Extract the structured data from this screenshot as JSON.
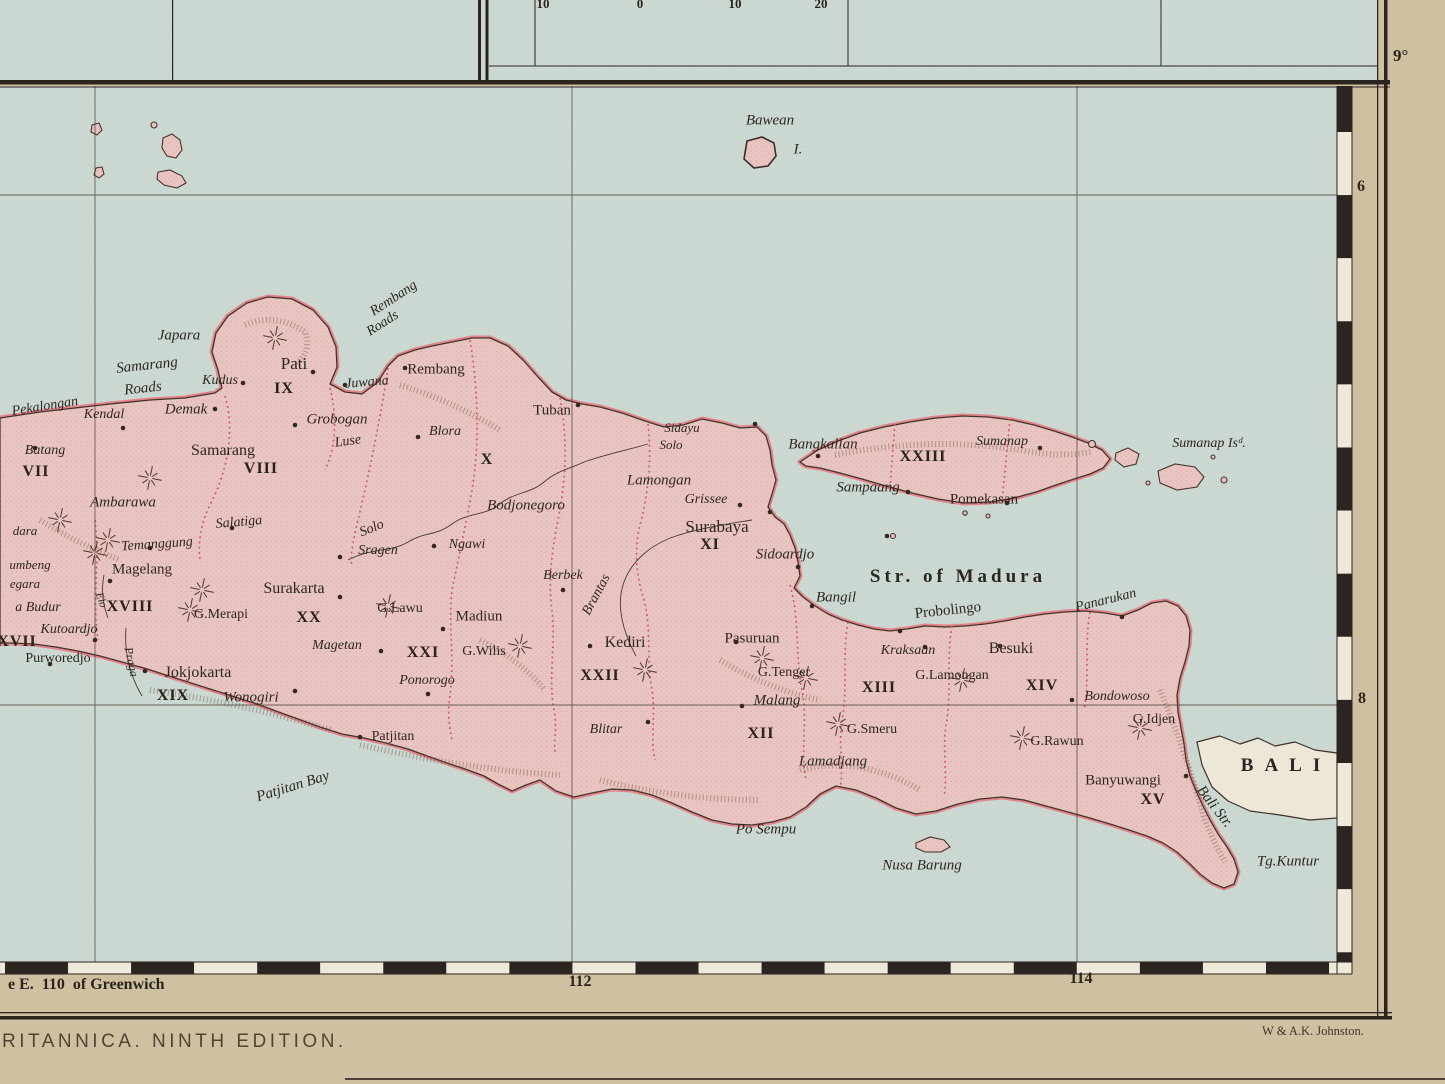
{
  "chrome": {
    "edition_text": "RITANNICA. NINTH EDITION.",
    "attribution": "W & A.K. Johnston.",
    "greenwich_label": "e E.  110  of Greenwich",
    "lon_112": "112",
    "lon_114": "114",
    "lat_9": "9°",
    "lat_6": "6",
    "lat_8": "8",
    "scale_numbers": [
      "10",
      "0",
      "10",
      "20"
    ]
  },
  "map": {
    "colors": {
      "sea": "#ccd8d2",
      "land": "#e9c5c1",
      "coast_band": "#e2858b",
      "outline": "#43342b",
      "boundary_red": "#cf5168",
      "paper_margin": "#cfc0a2",
      "ink": "#2b241e",
      "bali_fill": "#ede7d8"
    },
    "labels": [
      {
        "id": "bawean",
        "t": "Bawean",
        "x": 770,
        "y": 121,
        "c": "ital",
        "s": 15
      },
      {
        "id": "bawean-i",
        "t": "I.",
        "x": 798,
        "y": 150,
        "c": "ital",
        "s": 15
      },
      {
        "id": "str-of-madura",
        "t": "Str. of Madura",
        "x": 958,
        "y": 577,
        "c": "water",
        "s": 19,
        "ls": 4
      },
      {
        "id": "bali",
        "t": "BALI",
        "x": 1286,
        "y": 766,
        "c": "water",
        "s": 19,
        "ls": 11
      },
      {
        "id": "bali-str",
        "t": "Bali Str.",
        "x": 1214,
        "y": 807,
        "c": "ital",
        "s": 15,
        "r": 52
      },
      {
        "id": "tg-kuntur",
        "t": "Tg.Kuntur",
        "x": 1288,
        "y": 862,
        "c": "ital",
        "s": 15
      },
      {
        "id": "nusa-barung",
        "t": "Nusa Barung",
        "x": 922,
        "y": 866,
        "c": "ital",
        "s": 15
      },
      {
        "id": "po-sempu",
        "t": "Po Sempu",
        "x": 766,
        "y": 830,
        "c": "ital",
        "s": 15
      },
      {
        "id": "patjitan-bay",
        "t": "Patjitan Bay",
        "x": 293,
        "y": 787,
        "c": "ital",
        "s": 15,
        "r": -17
      },
      {
        "id": "rembang-roads-1",
        "t": "Rembang",
        "x": 394,
        "y": 299,
        "c": "ital",
        "s": 14,
        "r": -33
      },
      {
        "id": "rembang-roads-2",
        "t": "Roads",
        "x": 383,
        "y": 324,
        "c": "ital",
        "s": 14,
        "r": -33
      },
      {
        "id": "samarang-roads-1",
        "t": "Samarang",
        "x": 147,
        "y": 366,
        "c": "ital",
        "s": 15,
        "r": -6
      },
      {
        "id": "samarang-roads-2",
        "t": "Roads",
        "x": 143,
        "y": 389,
        "c": "ital",
        "s": 15,
        "r": -6
      },
      {
        "id": "sumanap-islands",
        "t": "Sumanap Isᵈ.",
        "x": 1209,
        "y": 444,
        "c": "ital",
        "s": 14
      },
      {
        "id": "pekalongan",
        "t": "Pekalongan",
        "x": 45,
        "y": 407,
        "c": "ital",
        "s": 14,
        "r": -9
      },
      {
        "id": "kendal",
        "t": "Kendal",
        "x": 104,
        "y": 415,
        "c": "ital",
        "s": 14
      },
      {
        "id": "batang",
        "t": "Batang",
        "x": 45,
        "y": 451,
        "c": "ital",
        "s": 14
      },
      {
        "id": "demak",
        "t": "Demak",
        "x": 186,
        "y": 410,
        "c": "ital",
        "s": 15
      },
      {
        "id": "japara",
        "t": "Japara",
        "x": 179,
        "y": 336,
        "c": "ital",
        "s": 15
      },
      {
        "id": "kudus",
        "t": "Kudus",
        "x": 220,
        "y": 381,
        "c": "ital",
        "s": 14
      },
      {
        "id": "juwana",
        "t": "Juwana",
        "x": 367,
        "y": 383,
        "c": "ital",
        "s": 14,
        "r": -5
      },
      {
        "id": "grobogan",
        "t": "Grobogan",
        "x": 337,
        "y": 420,
        "c": "ital",
        "s": 15
      },
      {
        "id": "luse",
        "t": "Luse",
        "x": 348,
        "y": 442,
        "c": "ital",
        "s": 14,
        "r": -8
      },
      {
        "id": "ambarawa",
        "t": "Ambarawa",
        "x": 123,
        "y": 503,
        "c": "ital",
        "s": 15
      },
      {
        "id": "salatiga",
        "t": "Salatiga",
        "x": 239,
        "y": 523,
        "c": "ital",
        "s": 14,
        "r": -5
      },
      {
        "id": "temanggung",
        "t": "Temanggung",
        "x": 157,
        "y": 545,
        "c": "ital",
        "s": 14,
        "r": -4
      },
      {
        "id": "sragen",
        "t": "Sragen",
        "x": 378,
        "y": 551,
        "c": "ital",
        "s": 14
      },
      {
        "id": "ngawi",
        "t": "Ngawi",
        "x": 467,
        "y": 545,
        "c": "ital",
        "s": 14
      },
      {
        "id": "bodjonegoro",
        "t": "Bodjonegoro",
        "x": 526,
        "y": 506,
        "c": "ital",
        "s": 15
      },
      {
        "id": "blora",
        "t": "Blora",
        "x": 445,
        "y": 432,
        "c": "ital",
        "s": 14
      },
      {
        "id": "sidayu",
        "t": "Sidayu",
        "x": 682,
        "y": 428,
        "c": "ital",
        "s": 13
      },
      {
        "id": "solo-upper",
        "t": "Solo",
        "x": 372,
        "y": 529,
        "c": "ital",
        "s": 14,
        "r": -22
      },
      {
        "id": "solo-lower",
        "t": "Solo",
        "x": 671,
        "y": 445,
        "c": "ital",
        "s": 13
      },
      {
        "id": "lamongan",
        "t": "Lamongan",
        "x": 659,
        "y": 481,
        "c": "ital",
        "s": 15
      },
      {
        "id": "grissee",
        "t": "Grissee",
        "x": 706,
        "y": 500,
        "c": "ital",
        "s": 14
      },
      {
        "id": "sidoardjo",
        "t": "Sidoardjo",
        "x": 785,
        "y": 555,
        "c": "ital",
        "s": 15
      },
      {
        "id": "bangil",
        "t": "Bangil",
        "x": 836,
        "y": 598,
        "c": "ital",
        "s": 15
      },
      {
        "id": "berbek",
        "t": "Berbek",
        "x": 563,
        "y": 576,
        "c": "ital",
        "s": 14
      },
      {
        "id": "magetan",
        "t": "Magetan",
        "x": 337,
        "y": 646,
        "c": "ital",
        "s": 14
      },
      {
        "id": "ponorogo",
        "t": "Ponorogo",
        "x": 427,
        "y": 681,
        "c": "ital",
        "s": 14
      },
      {
        "id": "wonogiri",
        "t": "Wonogiri",
        "x": 251,
        "y": 698,
        "c": "ital",
        "s": 15
      },
      {
        "id": "boro-budur",
        "t": "a Budur",
        "x": 38,
        "y": 608,
        "c": "ital",
        "s": 14
      },
      {
        "id": "kutoardjo",
        "t": "Kutoardjo",
        "x": 69,
        "y": 630,
        "c": "ital",
        "s": 14
      },
      {
        "id": "negara",
        "t": "egara",
        "x": 25,
        "y": 584,
        "c": "ital",
        "s": 13
      },
      {
        "id": "sumbeng",
        "t": "umbeng",
        "x": 30,
        "y": 565,
        "c": "ital",
        "s": 13
      },
      {
        "id": "sindara",
        "t": "dara",
        "x": 25,
        "y": 531,
        "c": "ital",
        "s": 13
      },
      {
        "id": "elo-river",
        "t": "Elo",
        "x": 101,
        "y": 600,
        "c": "ital",
        "s": 11,
        "r": 70
      },
      {
        "id": "praga-river",
        "t": "Praga",
        "x": 131,
        "y": 662,
        "c": "ital",
        "s": 12,
        "r": 78
      },
      {
        "id": "brantas-river",
        "t": "Brantas",
        "x": 597,
        "y": 595,
        "c": "ital",
        "s": 14,
        "r": -62
      },
      {
        "id": "malang",
        "t": "Malang",
        "x": 777,
        "y": 701,
        "c": "ital",
        "s": 15
      },
      {
        "id": "lamadjang",
        "t": "Lamadjang",
        "x": 833,
        "y": 762,
        "c": "ital",
        "s": 15
      },
      {
        "id": "kraksaan",
        "t": "Kraksaan",
        "x": 908,
        "y": 651,
        "c": "ital",
        "s": 14
      },
      {
        "id": "panarukan",
        "t": "Panarukan",
        "x": 1106,
        "y": 601,
        "c": "ital",
        "s": 14,
        "r": -14
      },
      {
        "id": "bondowoso",
        "t": "Bondowoso",
        "x": 1117,
        "y": 697,
        "c": "ital",
        "s": 14
      },
      {
        "id": "blitar",
        "t": "Blitar",
        "x": 606,
        "y": 730,
        "c": "ital",
        "s": 14
      },
      {
        "id": "bangkallan",
        "t": "Bangkallan",
        "x": 823,
        "y": 445,
        "c": "ital",
        "s": 15
      },
      {
        "id": "sampaang",
        "t": "Sampaang",
        "x": 868,
        "y": 488,
        "c": "ital",
        "s": 15
      },
      {
        "id": "sumanap",
        "t": "Sumanap",
        "x": 1002,
        "y": 442,
        "c": "ital",
        "s": 14
      },
      {
        "id": "pati",
        "t": "Pati",
        "x": 294,
        "y": 364,
        "c": "rom",
        "s": 17
      },
      {
        "id": "rembang",
        "t": "Rembang",
        "x": 436,
        "y": 370,
        "c": "rom",
        "s": 15
      },
      {
        "id": "tuban",
        "t": "Tuban",
        "x": 552,
        "y": 411,
        "c": "rom",
        "s": 15
      },
      {
        "id": "samarang",
        "t": "Samarang",
        "x": 223,
        "y": 451,
        "c": "rom",
        "s": 16
      },
      {
        "id": "magelang",
        "t": "Magelang",
        "x": 142,
        "y": 570,
        "c": "rom",
        "s": 15
      },
      {
        "id": "surakarta",
        "t": "Surakarta",
        "x": 294,
        "y": 589,
        "c": "rom",
        "s": 16
      },
      {
        "id": "jokjokarta",
        "t": "Jokjokarta",
        "x": 198,
        "y": 673,
        "c": "rom",
        "s": 16
      },
      {
        "id": "purworedjo",
        "t": "Purworedjo",
        "x": 58,
        "y": 659,
        "c": "rom",
        "s": 14
      },
      {
        "id": "surabaya",
        "t": "Surabaya",
        "x": 717,
        "y": 527,
        "c": "rom",
        "s": 17
      },
      {
        "id": "madiun",
        "t": "Madiun",
        "x": 479,
        "y": 617,
        "c": "rom",
        "s": 15
      },
      {
        "id": "kediri",
        "t": "Kediri",
        "x": 625,
        "y": 643,
        "c": "rom",
        "s": 16
      },
      {
        "id": "patjitan",
        "t": "Patjitan",
        "x": 393,
        "y": 737,
        "c": "rom",
        "s": 14
      },
      {
        "id": "pasuruan",
        "t": "Pasuruan",
        "x": 752,
        "y": 639,
        "c": "rom",
        "s": 15
      },
      {
        "id": "probolingo",
        "t": "Probolingo",
        "x": 948,
        "y": 611,
        "c": "rom",
        "s": 15,
        "r": -6
      },
      {
        "id": "besuki",
        "t": "Besuki",
        "x": 1011,
        "y": 649,
        "c": "rom",
        "s": 16
      },
      {
        "id": "banyuwangi",
        "t": "Banyuwangi",
        "x": 1123,
        "y": 781,
        "c": "rom",
        "s": 15
      },
      {
        "id": "pomekasan",
        "t": "Pomekasan",
        "x": 984,
        "y": 500,
        "c": "rom",
        "s": 15
      },
      {
        "id": "g-merapi",
        "t": "G.Merapi",
        "x": 221,
        "y": 615,
        "c": "rom",
        "s": 14
      },
      {
        "id": "g-lawu",
        "t": "G.Lawu",
        "x": 400,
        "y": 609,
        "c": "rom",
        "s": 14
      },
      {
        "id": "g-wilis",
        "t": "G.Wilis",
        "x": 484,
        "y": 652,
        "c": "rom",
        "s": 14
      },
      {
        "id": "g-tenger",
        "t": "G.Tenger",
        "x": 784,
        "y": 673,
        "c": "rom",
        "s": 14
      },
      {
        "id": "g-smeru",
        "t": "G.Smeru",
        "x": 872,
        "y": 730,
        "c": "rom",
        "s": 14
      },
      {
        "id": "g-lamongan",
        "t": "G.Lamongan",
        "x": 952,
        "y": 676,
        "c": "rom",
        "s": 14
      },
      {
        "id": "g-rawun",
        "t": "G.Rawun",
        "x": 1057,
        "y": 742,
        "c": "rom",
        "s": 14
      },
      {
        "id": "g-idjen",
        "t": "G.Idjen",
        "x": 1154,
        "y": 720,
        "c": "rom",
        "s": 14
      },
      {
        "id": "numeral-vii",
        "t": "VII",
        "x": 36,
        "y": 472,
        "c": "num"
      },
      {
        "id": "numeral-viii",
        "t": "VIII",
        "x": 261,
        "y": 469,
        "c": "num"
      },
      {
        "id": "numeral-ix",
        "t": "IX",
        "x": 284,
        "y": 389,
        "c": "num"
      },
      {
        "id": "numeral-x",
        "t": "X",
        "x": 487,
        "y": 460,
        "c": "num"
      },
      {
        "id": "numeral-xi",
        "t": "XI",
        "x": 710,
        "y": 545,
        "c": "num"
      },
      {
        "id": "numeral-xii",
        "t": "XII",
        "x": 761,
        "y": 734,
        "c": "num"
      },
      {
        "id": "numeral-xiii",
        "t": "XIII",
        "x": 879,
        "y": 688,
        "c": "num"
      },
      {
        "id": "numeral-xiv",
        "t": "XIV",
        "x": 1042,
        "y": 686,
        "c": "num"
      },
      {
        "id": "numeral-xv",
        "t": "XV",
        "x": 1153,
        "y": 800,
        "c": "num"
      },
      {
        "id": "numeral-xvii",
        "t": "XVII",
        "x": 17,
        "y": 642,
        "c": "num"
      },
      {
        "id": "numeral-xviii",
        "t": "XVIII",
        "x": 130,
        "y": 607,
        "c": "num"
      },
      {
        "id": "numeral-xix",
        "t": "XIX",
        "x": 173,
        "y": 696,
        "c": "num"
      },
      {
        "id": "numeral-xx",
        "t": "XX",
        "x": 309,
        "y": 618,
        "c": "num"
      },
      {
        "id": "numeral-xxi",
        "t": "XXI",
        "x": 423,
        "y": 653,
        "c": "num"
      },
      {
        "id": "numeral-xxii",
        "t": "XXII",
        "x": 600,
        "y": 676,
        "c": "num"
      },
      {
        "id": "numeral-xxiii",
        "t": "XXIII",
        "x": 923,
        "y": 457,
        "c": "num"
      }
    ],
    "towns": [
      [
        35,
        448
      ],
      [
        123,
        428
      ],
      [
        215,
        409
      ],
      [
        243,
        383
      ],
      [
        313,
        372
      ],
      [
        345,
        385
      ],
      [
        405,
        368
      ],
      [
        295,
        425
      ],
      [
        418,
        437
      ],
      [
        578,
        405
      ],
      [
        755,
        424
      ],
      [
        770,
        512
      ],
      [
        740,
        505
      ],
      [
        798,
        567
      ],
      [
        812,
        606
      ],
      [
        900,
        631
      ],
      [
        925,
        647
      ],
      [
        1000,
        646
      ],
      [
        1122,
        617
      ],
      [
        1072,
        700
      ],
      [
        1186,
        776
      ],
      [
        360,
        737
      ],
      [
        295,
        691
      ],
      [
        340,
        597
      ],
      [
        145,
        671
      ],
      [
        110,
        581
      ],
      [
        95,
        640
      ],
      [
        50,
        664
      ],
      [
        150,
        548
      ],
      [
        232,
        528
      ],
      [
        443,
        629
      ],
      [
        381,
        651
      ],
      [
        428,
        694
      ],
      [
        340,
        557
      ],
      [
        434,
        546
      ],
      [
        590,
        646
      ],
      [
        563,
        590
      ],
      [
        648,
        722
      ],
      [
        742,
        706
      ],
      [
        736,
        642
      ],
      [
        818,
        456
      ],
      [
        908,
        492
      ],
      [
        1007,
        503
      ],
      [
        1040,
        448
      ],
      [
        887,
        536
      ]
    ],
    "volcanoes": [
      [
        95,
        553
      ],
      [
        108,
        540
      ],
      [
        150,
        478
      ],
      [
        190,
        610
      ],
      [
        202,
        590
      ],
      [
        275,
        338
      ],
      [
        388,
        606
      ],
      [
        520,
        646
      ],
      [
        645,
        670
      ],
      [
        762,
        658
      ],
      [
        806,
        678
      ],
      [
        838,
        724
      ],
      [
        962,
        680
      ],
      [
        1022,
        738
      ],
      [
        1140,
        728
      ],
      [
        60,
        520
      ]
    ]
  }
}
